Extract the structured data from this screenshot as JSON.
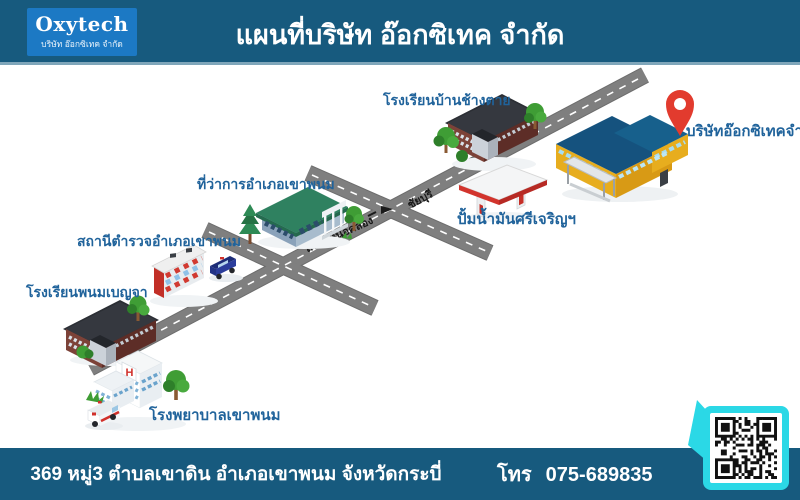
{
  "header": {
    "logo": {
      "name": "Oxytech",
      "subtitle": "บริษัท อ๊อกซิเทค จำกัด"
    },
    "title": "แผนที่บริษัท อ๊อกซิเทค จำกัด"
  },
  "map": {
    "locations": [
      {
        "id": "school-banchangtai",
        "label": "โรงเรียนบ้านช้างตาย"
      },
      {
        "id": "company-oxytech",
        "label": "บริษัทอ๊อกซิเทคจำกัด"
      },
      {
        "id": "district-office",
        "label": "ที่ว่าการอำเภอเขาพนม"
      },
      {
        "id": "gas-station",
        "label": "ปั้มน้ำมันศรีเจริญฯ"
      },
      {
        "id": "police-station",
        "label": "สถานีตำรวจอำเภอเขาพนม"
      },
      {
        "id": "school-phanombenja",
        "label": "โรงเรียนพนมเบญจา"
      },
      {
        "id": "hospital",
        "label": "โรงพยาบาลเขาพนม"
      }
    ],
    "roads": [
      {
        "id": "direction-chaiyaburi",
        "label": "ชัยบุรี"
      },
      {
        "id": "road-nuea-khlong",
        "label": "ถนนเหนือคลอง"
      }
    ]
  },
  "footer": {
    "address": "369 หมู่3 ตำบลเขาดิน อำเภอเขาพนม จังหวัดกระบี่",
    "phone_label": "โทร",
    "phone": "075-689835"
  },
  "colors": {
    "header_bg": "#175a7e",
    "logo_bg": "#1c79c4",
    "label_text": "#20639b",
    "road_gray": "#7f7f7f",
    "pin_red": "#e23b2e",
    "qr_frame_cyan": "#2bd8e6",
    "company_wall_yellow": "#e7ad1e",
    "company_roof_blue": "#15527e"
  }
}
